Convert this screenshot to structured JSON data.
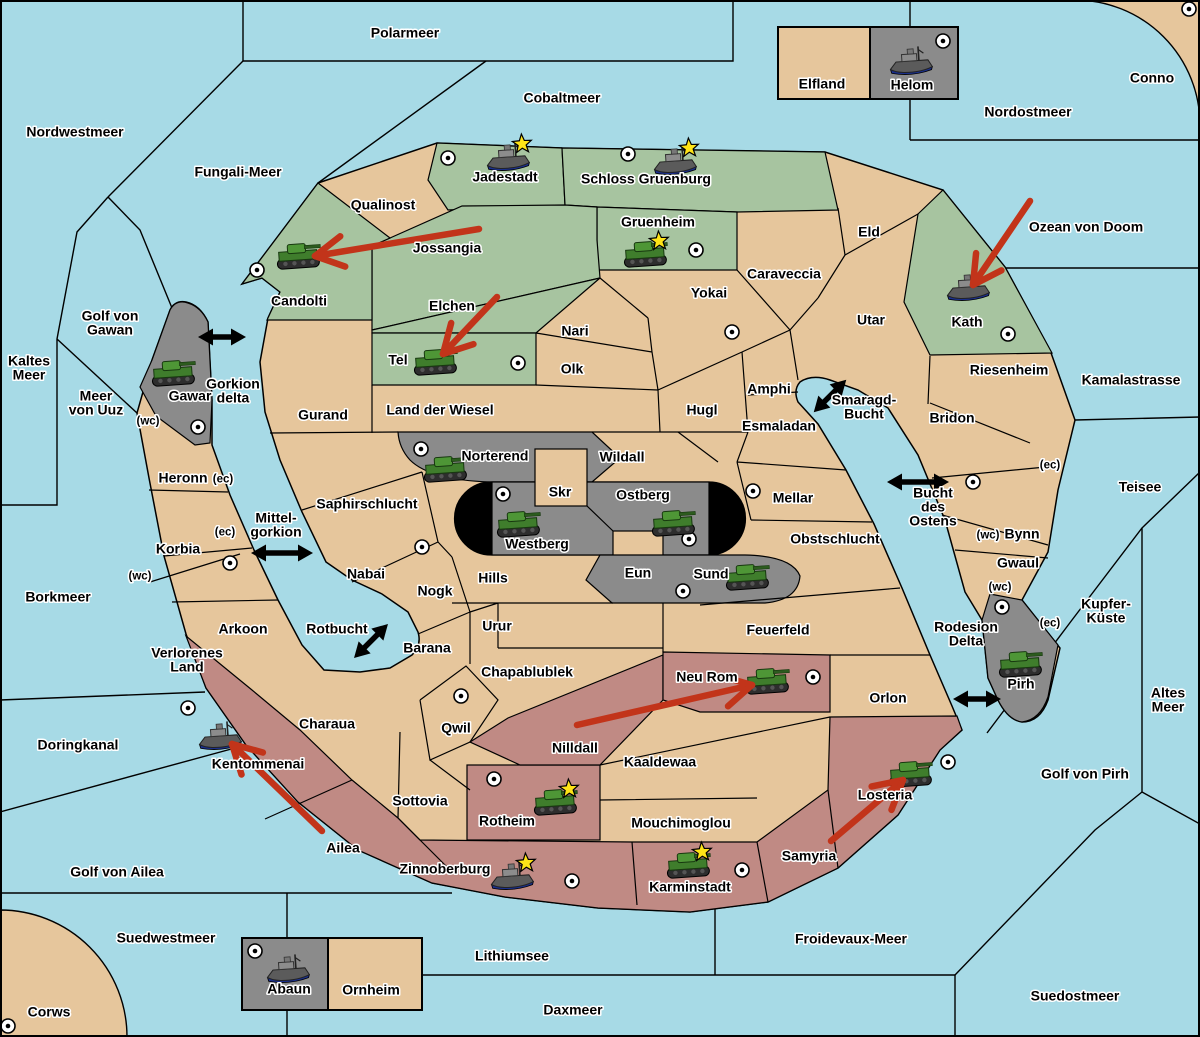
{
  "colors": {
    "sea": "#a7dae6",
    "land": "#e6c69c",
    "green": "#a7c4a0",
    "gray": "#8b8b8b",
    "red": "#c08a84",
    "black_zone": "#000000",
    "attack_arrow": "#c2341a",
    "link_arrow": "#000000",
    "star": "#ffe417",
    "border": "#000000"
  },
  "seas": [
    {
      "name": "Polarmeer",
      "x": 405,
      "y": 33
    },
    {
      "name": "Cobaltmeer",
      "x": 562,
      "y": 98
    },
    {
      "name": "Nordostmeer",
      "x": 1028,
      "y": 112
    },
    {
      "name": "Nordwestmeer",
      "x": 75,
      "y": 132
    },
    {
      "name": "Fungali-Meer",
      "x": 238,
      "y": 172
    },
    {
      "name": "Ozean von Doom",
      "x": 1086,
      "y": 227
    },
    {
      "name": "Kamalastrasse",
      "x": 1131,
      "y": 380
    },
    {
      "name": "Teisee",
      "x": 1140,
      "y": 487
    },
    {
      "name": "Kaltes Meer",
      "x": 29,
      "y": 368,
      "lines": [
        "Kaltes",
        "Meer"
      ]
    },
    {
      "name": "Golf von Gawan",
      "x": 110,
      "y": 323,
      "lines": [
        "Golf von",
        "Gawan"
      ]
    },
    {
      "name": "Meer von Uuz",
      "x": 96,
      "y": 403,
      "lines": [
        "Meer",
        "von Uuz"
      ]
    },
    {
      "name": "Gorkion delta",
      "x": 233,
      "y": 391,
      "lines": [
        "Gorkion",
        "delta"
      ]
    },
    {
      "name": "Mittel-gorkion",
      "x": 276,
      "y": 525,
      "lines": [
        "Mittel-",
        "gorkion"
      ]
    },
    {
      "name": "Borkmeer",
      "x": 58,
      "y": 597
    },
    {
      "name": "Smaragd-Bucht",
      "x": 864,
      "y": 407,
      "lines": [
        "Smaragd-",
        "Bucht"
      ]
    },
    {
      "name": "Bucht des Ostens",
      "x": 933,
      "y": 507,
      "lines": [
        "Bucht",
        "des",
        "Ostens"
      ]
    },
    {
      "name": "Rotbucht",
      "x": 337,
      "y": 629
    },
    {
      "name": "Rodesion Delta",
      "x": 966,
      "y": 634,
      "lines": [
        "Rodesion",
        "Delta"
      ]
    },
    {
      "name": "Kupfer-Küste",
      "x": 1106,
      "y": 611,
      "lines": [
        "Kupfer-",
        "Küste"
      ]
    },
    {
      "name": "Altes Meer",
      "x": 1168,
      "y": 700,
      "lines": [
        "Altes",
        "Meer"
      ]
    },
    {
      "name": "Golf von Pirh",
      "x": 1085,
      "y": 774
    },
    {
      "name": "Doringkanal",
      "x": 78,
      "y": 745
    },
    {
      "name": "Golf von Ailea",
      "x": 117,
      "y": 872
    },
    {
      "name": "Suedwestmeer",
      "x": 166,
      "y": 938
    },
    {
      "name": "Lithiumsee",
      "x": 512,
      "y": 956
    },
    {
      "name": "Daxmeer",
      "x": 573,
      "y": 1010
    },
    {
      "name": "Froidevaux-Meer",
      "x": 851,
      "y": 939
    },
    {
      "name": "Suedostmeer",
      "x": 1075,
      "y": 996
    }
  ],
  "territories": [
    {
      "name": "Jadestadt",
      "x": 505,
      "y": 177,
      "owner": "green"
    },
    {
      "name": "Schloss Gruenburg",
      "x": 646,
      "y": 179,
      "owner": "green"
    },
    {
      "name": "Gruenheim",
      "x": 658,
      "y": 222,
      "owner": "green"
    },
    {
      "name": "Qualinost",
      "x": 383,
      "y": 205,
      "owner": "neutral"
    },
    {
      "name": "Jossangia",
      "x": 447,
      "y": 248,
      "owner": "green"
    },
    {
      "name": "Candolti",
      "x": 299,
      "y": 301,
      "owner": "green"
    },
    {
      "name": "Elchen",
      "x": 452,
      "y": 306,
      "owner": "green"
    },
    {
      "name": "Tel",
      "x": 398,
      "y": 360,
      "owner": "green"
    },
    {
      "name": "Eld",
      "x": 869,
      "y": 232,
      "owner": "neutral"
    },
    {
      "name": "Caraveccia",
      "x": 784,
      "y": 274,
      "owner": "neutral"
    },
    {
      "name": "Yokai",
      "x": 709,
      "y": 293,
      "owner": "neutral"
    },
    {
      "name": "Utar",
      "x": 871,
      "y": 320,
      "owner": "neutral"
    },
    {
      "name": "Kath",
      "x": 967,
      "y": 322,
      "owner": "green"
    },
    {
      "name": "Riesenheim",
      "x": 1009,
      "y": 370,
      "owner": "neutral"
    },
    {
      "name": "Bridon",
      "x": 952,
      "y": 418,
      "owner": "neutral"
    },
    {
      "name": "Nari",
      "x": 575,
      "y": 331,
      "owner": "neutral"
    },
    {
      "name": "Olk",
      "x": 572,
      "y": 369,
      "owner": "neutral"
    },
    {
      "name": "Land der Wiesel",
      "x": 440,
      "y": 410,
      "owner": "neutral"
    },
    {
      "name": "Gurand",
      "x": 323,
      "y": 415,
      "owner": "neutral"
    },
    {
      "name": "Hugl",
      "x": 702,
      "y": 410,
      "owner": "neutral"
    },
    {
      "name": "Amphi",
      "x": 769,
      "y": 389,
      "owner": "neutral"
    },
    {
      "name": "Esmaladan",
      "x": 779,
      "y": 426,
      "owner": "neutral"
    },
    {
      "name": "Gawar",
      "x": 190,
      "y": 396,
      "owner": "gray"
    },
    {
      "name": "Heronn",
      "x": 183,
      "y": 478,
      "owner": "neutral"
    },
    {
      "name": "Korbia",
      "x": 178,
      "y": 549,
      "owner": "neutral"
    },
    {
      "name": "Norterend",
      "x": 495,
      "y": 456,
      "owner": "gray"
    },
    {
      "name": "Wildall",
      "x": 622,
      "y": 457,
      "owner": "neutral"
    },
    {
      "name": "Skr",
      "x": 560,
      "y": 492,
      "owner": "neutral"
    },
    {
      "name": "Ostberg",
      "x": 643,
      "y": 495,
      "owner": "gray"
    },
    {
      "name": "Westberg",
      "x": 537,
      "y": 544,
      "owner": "gray"
    },
    {
      "name": "Saphirschlucht",
      "x": 367,
      "y": 504,
      "owner": "neutral"
    },
    {
      "name": "Mellar",
      "x": 793,
      "y": 498,
      "owner": "neutral"
    },
    {
      "name": "Obstschlucht",
      "x": 835,
      "y": 539,
      "owner": "neutral"
    },
    {
      "name": "Bynn",
      "x": 1022,
      "y": 534,
      "owner": "neutral"
    },
    {
      "name": "Gwaul",
      "x": 1018,
      "y": 563,
      "owner": "neutral"
    },
    {
      "name": "Nabai",
      "x": 366,
      "y": 574,
      "owner": "neutral"
    },
    {
      "name": "Nogk",
      "x": 435,
      "y": 591,
      "owner": "neutral"
    },
    {
      "name": "Hills",
      "x": 493,
      "y": 578,
      "owner": "neutral"
    },
    {
      "name": "Eun",
      "x": 638,
      "y": 573,
      "owner": "neutral"
    },
    {
      "name": "Sund",
      "x": 711,
      "y": 574,
      "owner": "gray"
    },
    {
      "name": "Urur",
      "x": 497,
      "y": 626,
      "owner": "neutral"
    },
    {
      "name": "Arkoon",
      "x": 243,
      "y": 629,
      "owner": "neutral"
    },
    {
      "name": "Barana",
      "x": 427,
      "y": 648,
      "owner": "neutral"
    },
    {
      "name": "Feuerfeld",
      "x": 778,
      "y": 630,
      "owner": "neutral"
    },
    {
      "name": "Chapablublek",
      "x": 527,
      "y": 672,
      "owner": "neutral"
    },
    {
      "name": "Verlorenes Land",
      "x": 187,
      "y": 660,
      "owner": "neutral",
      "lines": [
        "Verlorenes",
        "Land"
      ]
    },
    {
      "name": "Neu Rom",
      "x": 707,
      "y": 677,
      "owner": "red"
    },
    {
      "name": "Orlon",
      "x": 888,
      "y": 698,
      "owner": "neutral"
    },
    {
      "name": "Pirh",
      "x": 1021,
      "y": 684,
      "owner": "gray"
    },
    {
      "name": "Charaua",
      "x": 327,
      "y": 724,
      "owner": "neutral"
    },
    {
      "name": "Qwil",
      "x": 456,
      "y": 728,
      "owner": "neutral"
    },
    {
      "name": "Nilldall",
      "x": 575,
      "y": 748,
      "owner": "red"
    },
    {
      "name": "Kaaldewaa",
      "x": 660,
      "y": 762,
      "owner": "neutral"
    },
    {
      "name": "Kentommenai",
      "x": 258,
      "y": 764,
      "owner": "red"
    },
    {
      "name": "Sottovia",
      "x": 420,
      "y": 801,
      "owner": "neutral"
    },
    {
      "name": "Mouchimoglou",
      "x": 681,
      "y": 823,
      "owner": "neutral"
    },
    {
      "name": "Losteria",
      "x": 885,
      "y": 795,
      "owner": "red"
    },
    {
      "name": "Ailea",
      "x": 343,
      "y": 848,
      "owner": "red"
    },
    {
      "name": "Samyria",
      "x": 809,
      "y": 856,
      "owner": "red"
    },
    {
      "name": "Rotheim",
      "x": 507,
      "y": 821,
      "owner": "red"
    },
    {
      "name": "Zinnoberburg",
      "x": 445,
      "y": 869,
      "owner": "red"
    },
    {
      "name": "Karminstadt",
      "x": 690,
      "y": 887,
      "owner": "red"
    },
    {
      "name": "Elfland",
      "x": 822,
      "y": 84,
      "owner": "neutral"
    },
    {
      "name": "Helom",
      "x": 912,
      "y": 85,
      "owner": "gray"
    },
    {
      "name": "Conno",
      "x": 1152,
      "y": 78,
      "owner": "neutral"
    },
    {
      "name": "Abaun",
      "x": 289,
      "y": 989,
      "owner": "gray"
    },
    {
      "name": "Ornheim",
      "x": 371,
      "y": 990,
      "owner": "neutral"
    },
    {
      "name": "Corws",
      "x": 49,
      "y": 1012,
      "owner": "neutral"
    }
  ],
  "coast_labels": [
    {
      "text": "(wc)",
      "x": 148,
      "y": 420
    },
    {
      "text": "(ec)",
      "x": 223,
      "y": 478
    },
    {
      "text": "(ec)",
      "x": 225,
      "y": 531
    },
    {
      "text": "(wc)",
      "x": 140,
      "y": 575
    },
    {
      "text": "(ec)",
      "x": 1050,
      "y": 464
    },
    {
      "text": "(wc)",
      "x": 988,
      "y": 534
    },
    {
      "text": "(wc)",
      "x": 1000,
      "y": 586
    },
    {
      "text": "(ec)",
      "x": 1050,
      "y": 622
    }
  ],
  "markers": [
    {
      "x": 448,
      "y": 158
    },
    {
      "x": 628,
      "y": 154
    },
    {
      "x": 696,
      "y": 250
    },
    {
      "x": 943,
      "y": 41
    },
    {
      "x": 1189,
      "y": 9
    },
    {
      "x": 257,
      "y": 270
    },
    {
      "x": 518,
      "y": 363
    },
    {
      "x": 732,
      "y": 332
    },
    {
      "x": 198,
      "y": 427
    },
    {
      "x": 421,
      "y": 449
    },
    {
      "x": 503,
      "y": 494
    },
    {
      "x": 689,
      "y": 539
    },
    {
      "x": 753,
      "y": 491
    },
    {
      "x": 683,
      "y": 591
    },
    {
      "x": 422,
      "y": 547
    },
    {
      "x": 230,
      "y": 563
    },
    {
      "x": 973,
      "y": 482
    },
    {
      "x": 1008,
      "y": 334
    },
    {
      "x": 1002,
      "y": 607
    },
    {
      "x": 813,
      "y": 677
    },
    {
      "x": 948,
      "y": 762
    },
    {
      "x": 188,
      "y": 708
    },
    {
      "x": 461,
      "y": 696
    },
    {
      "x": 494,
      "y": 779
    },
    {
      "x": 572,
      "y": 881
    },
    {
      "x": 742,
      "y": 870
    },
    {
      "x": 255,
      "y": 951
    },
    {
      "x": 8,
      "y": 1026
    }
  ],
  "units": [
    {
      "type": "tank",
      "x": 173,
      "y": 374,
      "star": false
    },
    {
      "type": "tank",
      "x": 298,
      "y": 257,
      "star": false
    },
    {
      "type": "tank",
      "x": 435,
      "y": 363,
      "star": false
    },
    {
      "type": "tank",
      "x": 645,
      "y": 255,
      "star": true
    },
    {
      "type": "tank",
      "x": 445,
      "y": 470,
      "star": false
    },
    {
      "type": "tank",
      "x": 518,
      "y": 525,
      "star": false
    },
    {
      "type": "tank",
      "x": 673,
      "y": 524,
      "star": false
    },
    {
      "type": "tank",
      "x": 747,
      "y": 578,
      "star": false
    },
    {
      "type": "tank",
      "x": 1020,
      "y": 665,
      "star": false
    },
    {
      "type": "tank",
      "x": 767,
      "y": 682,
      "star": false
    },
    {
      "type": "tank",
      "x": 910,
      "y": 775,
      "star": false
    },
    {
      "type": "tank",
      "x": 555,
      "y": 803,
      "star": true
    },
    {
      "type": "tank",
      "x": 688,
      "y": 866,
      "star": true
    },
    {
      "type": "ship",
      "x": 508,
      "y": 158,
      "star": true
    },
    {
      "type": "ship",
      "x": 675,
      "y": 162,
      "star": true
    },
    {
      "type": "ship",
      "x": 911,
      "y": 62,
      "star": false
    },
    {
      "type": "ship",
      "x": 968,
      "y": 288,
      "star": false
    },
    {
      "type": "ship",
      "x": 220,
      "y": 737,
      "star": false
    },
    {
      "type": "ship",
      "x": 512,
      "y": 877,
      "star": true
    },
    {
      "type": "ship",
      "x": 288,
      "y": 970,
      "star": false
    }
  ],
  "attack_arrows": [
    {
      "x1": 479,
      "y1": 229,
      "x2": 315,
      "y2": 256
    },
    {
      "x1": 497,
      "y1": 297,
      "x2": 443,
      "y2": 354
    },
    {
      "x1": 1030,
      "y1": 201,
      "x2": 973,
      "y2": 285
    },
    {
      "x1": 577,
      "y1": 725,
      "x2": 752,
      "y2": 685
    },
    {
      "x1": 831,
      "y1": 841,
      "x2": 903,
      "y2": 780
    },
    {
      "x1": 322,
      "y1": 831,
      "x2": 232,
      "y2": 744
    }
  ],
  "link_arrows": [
    {
      "x": 222,
      "y": 337,
      "angle": 0,
      "len": 48
    },
    {
      "x": 282,
      "y": 553,
      "angle": 0,
      "len": 62
    },
    {
      "x": 371,
      "y": 641,
      "angle": -45,
      "len": 48
    },
    {
      "x": 830,
      "y": 396,
      "angle": -45,
      "len": 46
    },
    {
      "x": 918,
      "y": 482,
      "angle": 0,
      "len": 62
    },
    {
      "x": 977,
      "y": 699,
      "angle": 0,
      "len": 48
    }
  ]
}
